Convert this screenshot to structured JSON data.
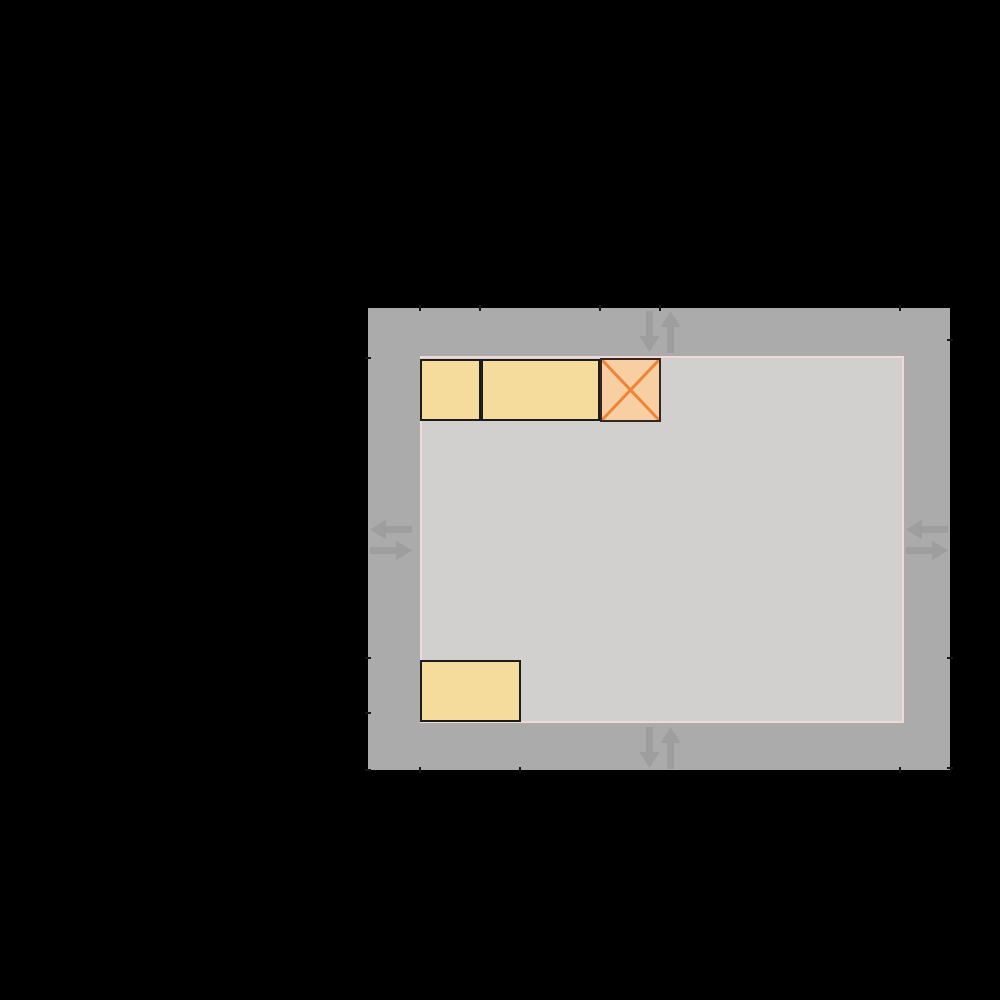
{
  "figure": {
    "description": "Top-down room layout diagram on black background: gray border zone with two-way traffic arrows, light gray room, yellow furniture boxes, orange crossed obstacle",
    "background_color": "#000000",
    "border_zone": {
      "x": 368,
      "y": 308,
      "w": 582,
      "h": 462,
      "color": "#ababab"
    },
    "room": {
      "x": 420,
      "y": 356,
      "w": 484,
      "h": 367,
      "fill": "#d2d0cf",
      "border_color": "#f0d9d7",
      "border_width": 2
    },
    "box_style": {
      "fill": "#f5db9c",
      "border_color": "#1c1c1c",
      "border_width": 2
    },
    "boxes": [
      {
        "name": "furniture-box-top-left",
        "x": 420,
        "y": 359,
        "w": 61,
        "h": 62
      },
      {
        "name": "furniture-box-top-middle",
        "x": 481,
        "y": 359,
        "w": 119,
        "h": 62
      },
      {
        "name": "furniture-box-bottom-left",
        "x": 420,
        "y": 660,
        "w": 101,
        "h": 62
      }
    ],
    "hazard": {
      "name": "crossed-obstacle-box",
      "x": 600,
      "y": 358,
      "w": 61,
      "h": 64,
      "fill": "#f8cfa3",
      "cross_color": "#ee8435",
      "border_color": "#33281e",
      "border_width": 2
    },
    "arrows": {
      "color": "#9e9e9e",
      "groups": [
        {
          "id": "top",
          "type": "vertical-pair",
          "icon": "down-up-arrow-icon",
          "cx": 660,
          "cy": 332
        },
        {
          "id": "bottom",
          "type": "vertical-pair",
          "icon": "down-up-arrow-icon",
          "cx": 660,
          "cy": 748
        },
        {
          "id": "left",
          "type": "horizontal-pair",
          "icon": "left-right-arrow-icon",
          "cx": 391,
          "cy": 540
        },
        {
          "id": "right",
          "type": "horizontal-pair",
          "icon": "left-right-arrow-icon",
          "cx": 927,
          "cy": 540
        }
      ]
    },
    "ticks": {
      "color": "#161616",
      "top_x": [
        420,
        480,
        600,
        660,
        900
      ],
      "bottom_x": [
        420,
        520,
        900
      ],
      "left_y": [
        358,
        658,
        713,
        770
      ],
      "right_y": [
        340,
        658,
        768
      ]
    }
  }
}
